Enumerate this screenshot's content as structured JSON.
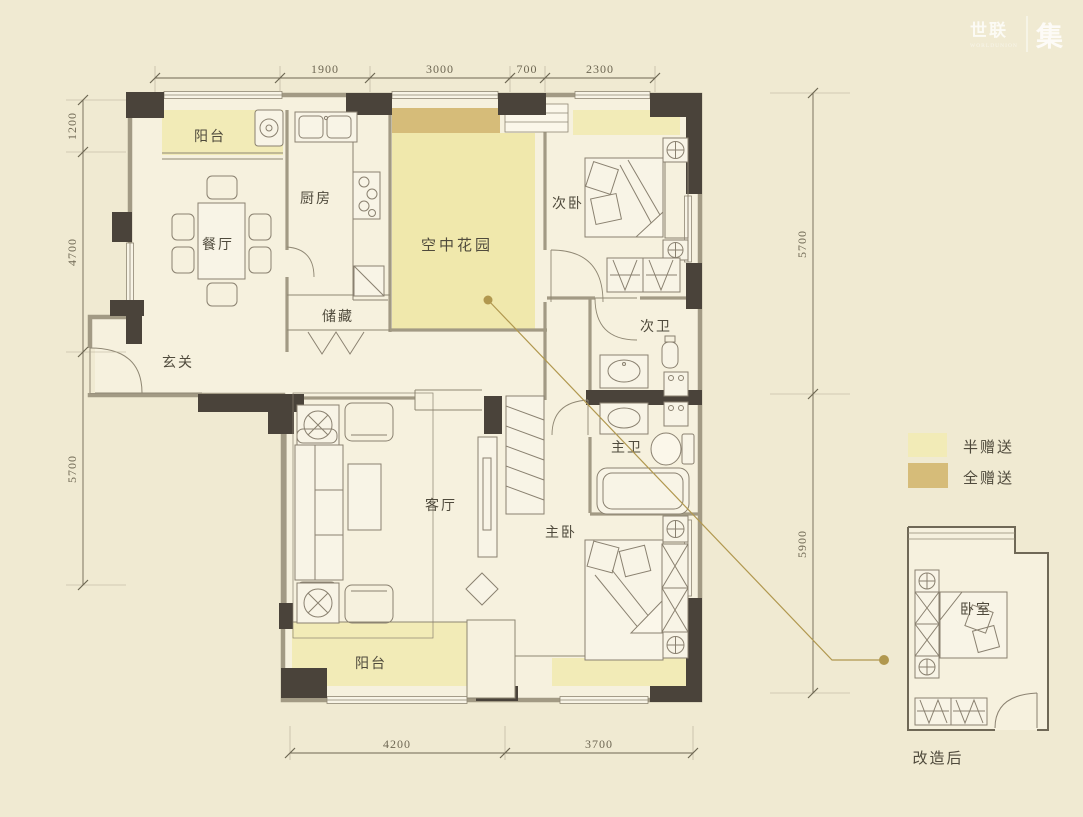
{
  "watermark": {
    "brand": "世联",
    "sub": "WORLDUNION",
    "suffix": "集"
  },
  "legend": {
    "items": [
      {
        "label": "半赠送",
        "color": "#f2ebb7"
      },
      {
        "label": "全赠送",
        "color": "#d6bc79"
      }
    ]
  },
  "rooms": {
    "balcony_top": "阳台",
    "dining": "餐厅",
    "kitchen": "厨房",
    "storage": "储藏",
    "foyer": "玄关",
    "sky_garden": "空中花园",
    "bedroom2": "次卧",
    "bath2": "次卫",
    "bath_master": "主卫",
    "living": "客厅",
    "bedroom_master": "主卧",
    "balcony_bottom": "阳台"
  },
  "inset": {
    "room": "卧室",
    "caption": "改造后"
  },
  "dimensions": {
    "top": [
      "1900",
      "3000",
      "700",
      "2300"
    ],
    "left": [
      "1200",
      "4700",
      "5700"
    ],
    "right": [
      "5700",
      "5900"
    ],
    "bottom": [
      "4200",
      "3700"
    ]
  },
  "colors": {
    "background": "#f0ead2",
    "floor": "#f6f1de",
    "half_gift": "#f2ebb7",
    "full_gift": "#d6bc79",
    "wall_dark": "#4a433a",
    "wall_band": "#a29a84",
    "leader": "#b1984f",
    "dim": "#6e6753"
  }
}
